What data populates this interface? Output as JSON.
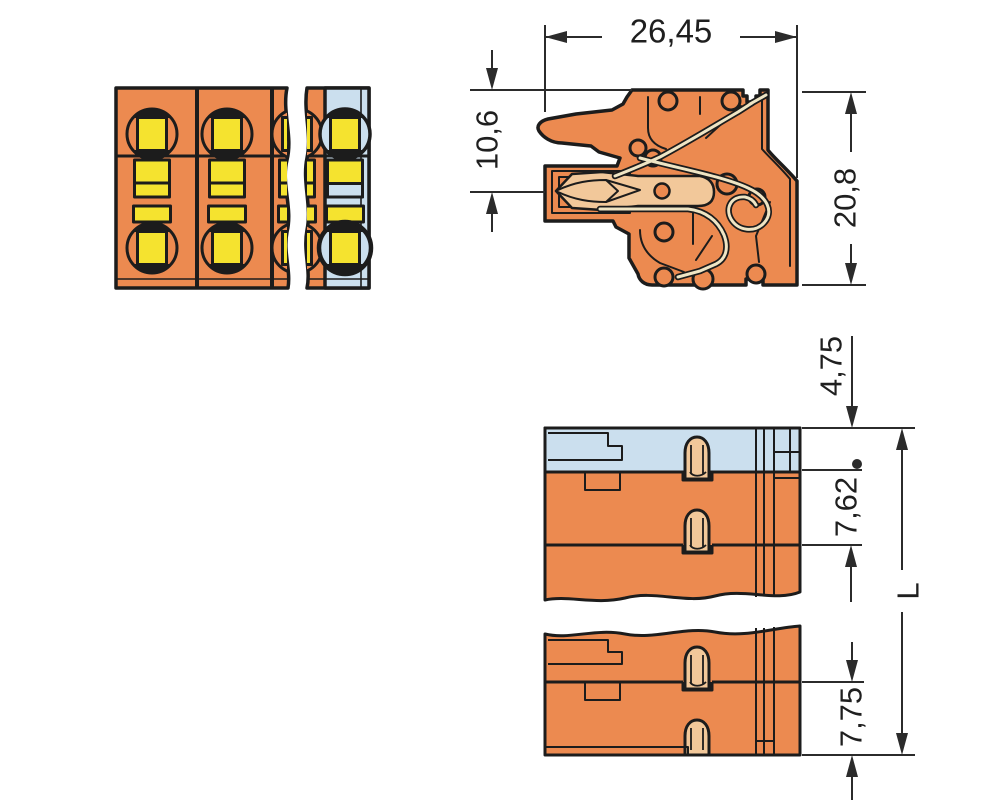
{
  "dimensions": {
    "overall_width": "26,45",
    "wire_entry_height": "10,6",
    "overall_height": "20,8",
    "first_pole_offset": "4,75",
    "pole_pitch": "7,62",
    "end_pole_pitch": "7,75",
    "overall_length": "L"
  },
  "colors": {
    "housing": "#EC8A50",
    "contact": "#F5E32F",
    "endplate": "#CBDFEE",
    "conductor": "#F2C89A",
    "spring": "#EFE5C4",
    "line": "#1C1C1C",
    "dim": "#2B2B2B",
    "background": "#FFFFFF"
  }
}
